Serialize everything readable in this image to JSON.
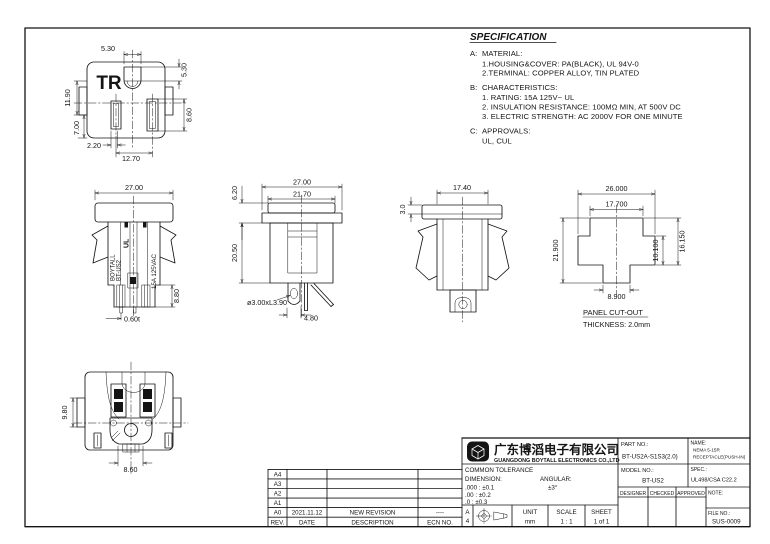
{
  "spec": {
    "title": "SPECIFICATION",
    "a_label": "A:",
    "a_head": "MATERIAL:",
    "a1": "1.HOUSING&COVER: PA(BLACK), UL 94V-0",
    "a2": "2.TERMINAL: COPPER ALLOY, TIN PLATED",
    "b_label": "B:",
    "b_head": "CHARACTERISTICS:",
    "b1": "1. RATING: 15A 125V~ UL",
    "b2": "2. INSULATION RESISTANCE: 100MΩ MIN, AT 500V DC",
    "b3": "3. ELECTRIC STRENGTH: AC 2000V FOR ONE MINUTE",
    "c_label": "C:",
    "c_head": "APPROVALS:",
    "c1": "UL, CUL"
  },
  "face": {
    "marking": "TR",
    "hole_w": "5.30",
    "hole_h": "5.30",
    "upper_left": "11.90",
    "slot_h": "8.60",
    "lower_left": "7.00",
    "slot_offset": "2.20",
    "slot_pitch": "12.70"
  },
  "front": {
    "width": "27.00",
    "tail_h": "8.80",
    "pin_thk": "0.60t",
    "brand1": "BOYTALL",
    "brand2": "BT-US2",
    "ul": "UL",
    "rating": "15A 125VAC"
  },
  "side": {
    "width": "27.00",
    "inner_w": "21.70",
    "flange_h": "6.20",
    "body_h": "20.50",
    "hole": "ø3.00xL3.90",
    "pin_w": "4.80"
  },
  "latch": {
    "width": "17.40",
    "flange_h": "3.0"
  },
  "cutout": {
    "w": "26.000",
    "w2": "17.700",
    "h": "21.900",
    "h2": "16.150",
    "h3": "10.100",
    "tab": "8.900",
    "label": "PANEL CUT-OUT",
    "thickness": "THICKNESS: 2.0mm"
  },
  "rear": {
    "tab_h": "9.80",
    "center_w": "8.60"
  },
  "rev": {
    "r0": "A4",
    "r1": "A3",
    "r2": "A2",
    "r3": "A1",
    "r4": "A0",
    "date": "2021.11.12",
    "desc": "NEW REVISION",
    "ecn": "----",
    "h_rev": "REV.",
    "h_date": "DATE",
    "h_desc": "DESCRIPTION",
    "h_ecn": "ECN NO."
  },
  "tb": {
    "company_cn": "广东博滔电子有限公司",
    "company_en": "GUANGDONG BOYTALL ELECTRONICS CO.,LTD",
    "part_label": "PART NO.:",
    "part_no": "BT-US2A-S1S3(2.0)",
    "name_label": "NAME:",
    "name1": "NEMA 5-15R",
    "name2": "RECEPTACLE(PUSH-IN)",
    "model_label": "MODEL NO.:",
    "model_no": "BT-US2",
    "spec_label": "SPEC.:",
    "spec_value": "UL498/CSA C22.2",
    "designer": "DESIGNER",
    "checked": "CHECKED",
    "approved": "APPROVED",
    "note_label": "NOTE:",
    "file_label": "FILE NO.:",
    "file_no": "SUS-0009",
    "tol_title": "COMMON TOLERANCE",
    "dim_label": "DIMENSION:",
    "ang_label": "ANGULAR:",
    "ang_value": "±3°",
    "tol1": ".000 : ±0.1",
    "tol2": ".00 : ±0.2",
    "tol3": ".0 : ±0.3",
    "size1": "A",
    "size2": "4",
    "unit_label": "UNIT",
    "unit": "mm",
    "scale_label": "SCALE",
    "scale": "1 : 1",
    "sheet_label": "SHEET",
    "sheet": "1 of 1"
  }
}
